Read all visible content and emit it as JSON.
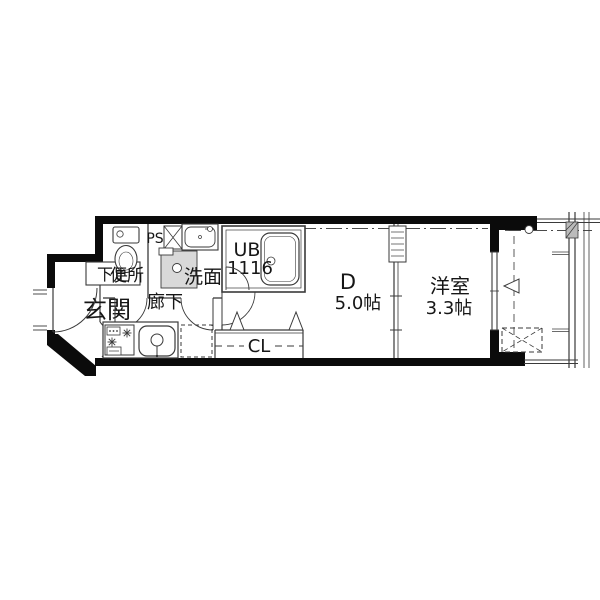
{
  "title": "apartment-floor-plan",
  "colors": {
    "wall": "#0b0b0b",
    "line": "#2e2e2e",
    "background": "#ffffff",
    "fixture_gray": "#d9d9d9"
  },
  "rooms": {
    "shoe_storage": {
      "label": "下足"
    },
    "entrance": {
      "label": "玄関"
    },
    "toilet": {
      "label": "便所"
    },
    "pipe_space": {
      "label": "PS"
    },
    "washroom": {
      "label": "洗面"
    },
    "unit_bath": {
      "label": "UB",
      "size": "1116"
    },
    "hallway": {
      "label": "廊下"
    },
    "closet": {
      "label": "CL"
    },
    "dining": {
      "label": "D",
      "size": "5.0帖"
    },
    "western_room": {
      "label": "洋室",
      "size": "3.3帖"
    }
  }
}
